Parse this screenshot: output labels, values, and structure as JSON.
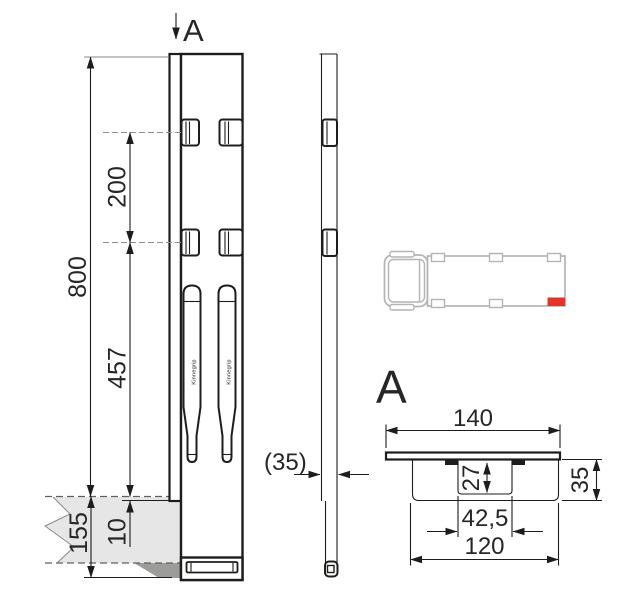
{
  "drawing": {
    "section_marker": {
      "label": "A"
    },
    "section_detail": {
      "title": "A"
    },
    "brand_text": "Kinnegrip",
    "dimensions": {
      "front": {
        "total_height": "800",
        "hole_spacing": "200",
        "hole_to_platform": "457",
        "platform_overlap": "10",
        "below_platform": "155"
      },
      "side": {
        "thickness": "(35)"
      },
      "section": {
        "overall_width": "140",
        "recess_depth": "27",
        "height": "35",
        "recess_width": "42,5",
        "body_width": "120"
      }
    },
    "colors": {
      "line": "#1d1d1b",
      "platform_fill": "#e6e6e6",
      "platform_shadow": "#9c9c9b",
      "truck_outline": "#b4b4b4",
      "location_marker_red": "#e5332a"
    }
  }
}
